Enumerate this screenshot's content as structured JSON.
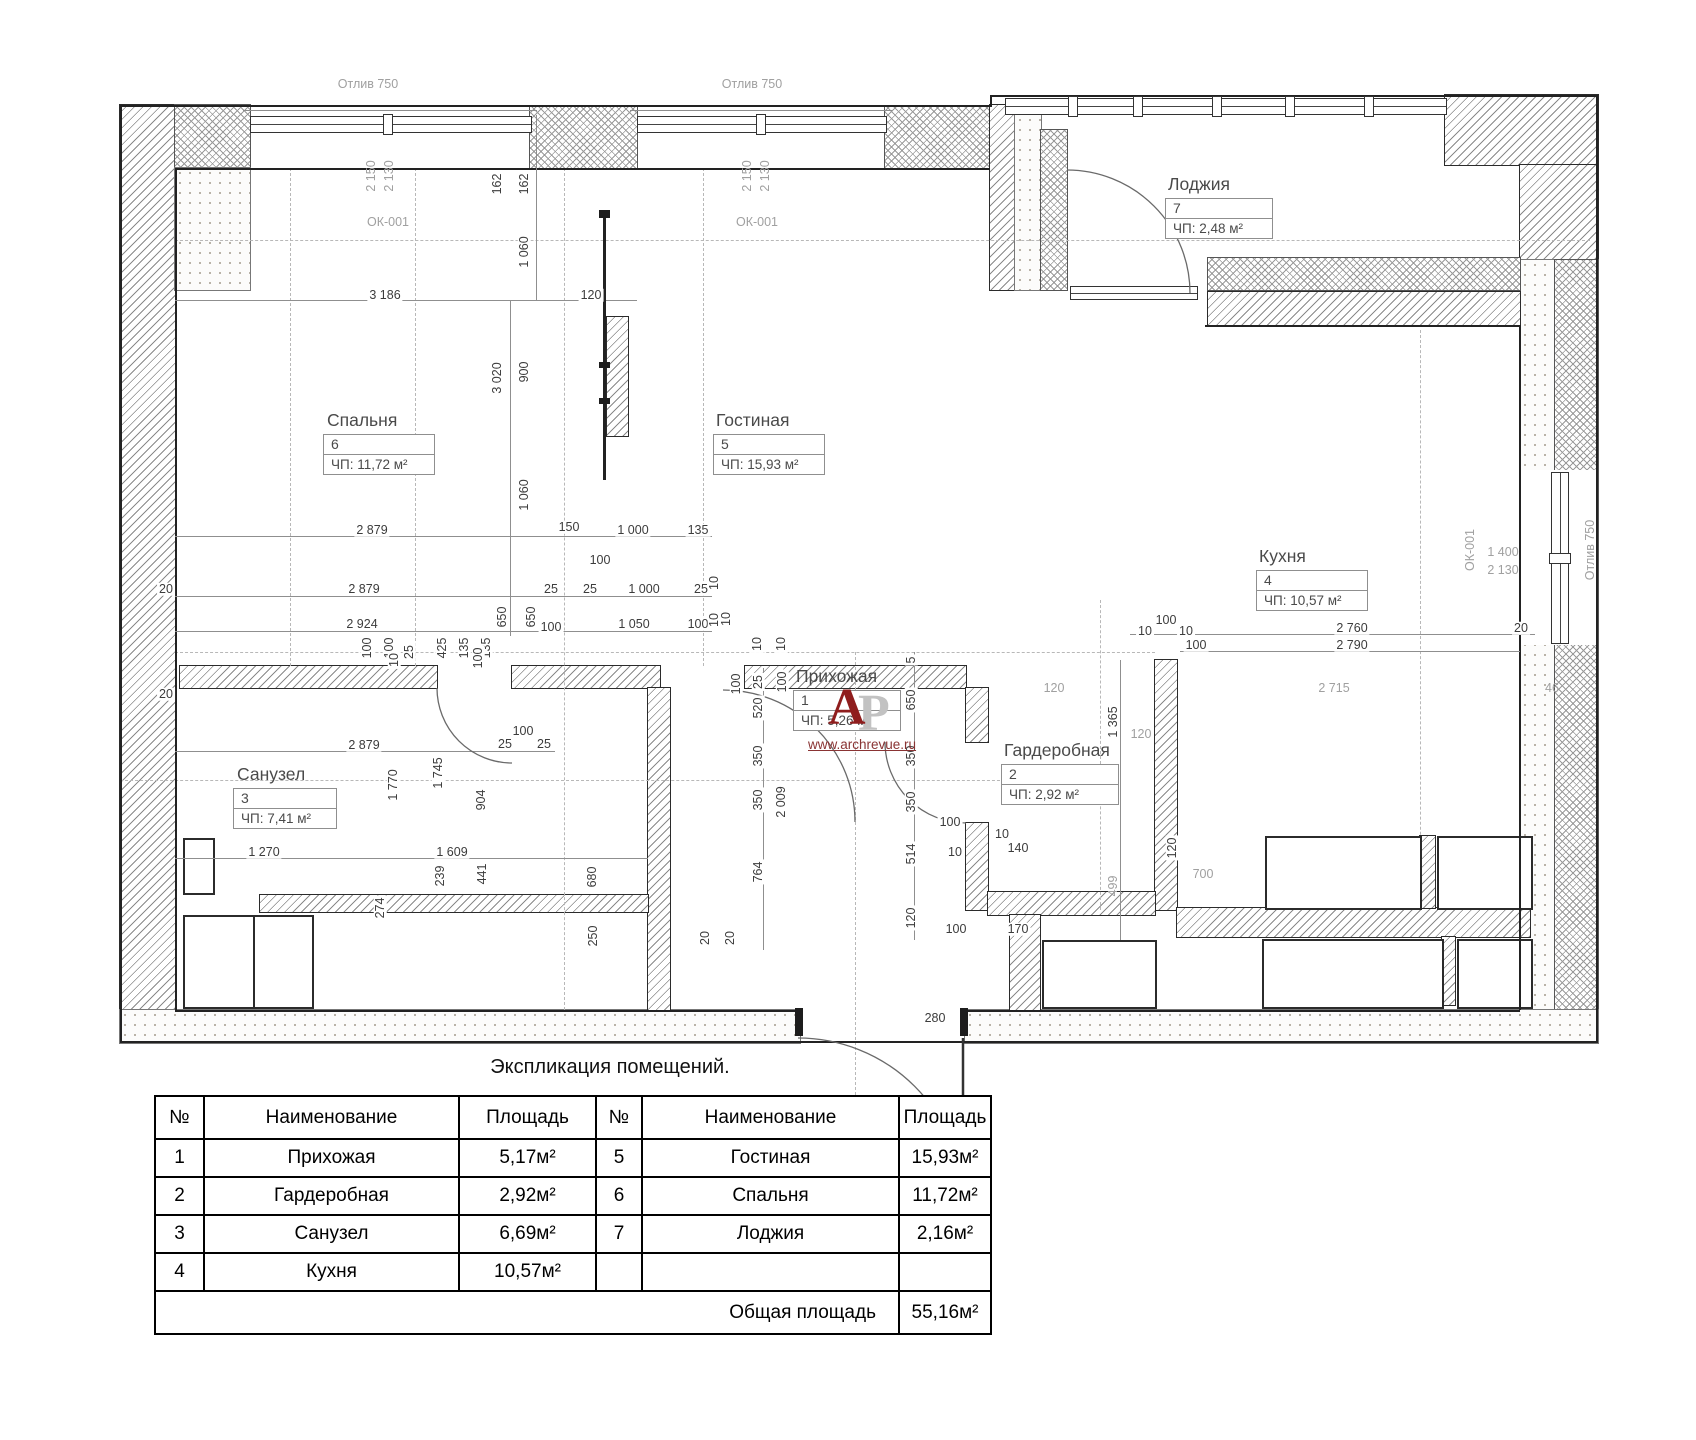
{
  "plan": {
    "rooms": [
      {
        "name": "Спальня",
        "num": "6",
        "area": "ЧП: 11,72 м²",
        "lx": 327,
        "ly": 412,
        "bx": 323,
        "by": 434,
        "bw": 110
      },
      {
        "name": "Гостиная",
        "num": "5",
        "area": "ЧП: 15,93 м²",
        "lx": 716,
        "ly": 412,
        "bx": 713,
        "by": 434,
        "bw": 110
      },
      {
        "name": "Лоджия",
        "num": "7",
        "area": "ЧП: 2,48 м²",
        "lx": 1168,
        "ly": 176,
        "bx": 1165,
        "by": 198,
        "bw": 106
      },
      {
        "name": "Кухня",
        "num": "4",
        "area": "ЧП: 10,57 м²",
        "lx": 1259,
        "ly": 548,
        "bx": 1256,
        "by": 570,
        "bw": 110
      },
      {
        "name": "Прихожая",
        "num": "1",
        "area": "ЧП: 5,26 м²",
        "lx": 796,
        "ly": 668,
        "bx": 793,
        "by": 690,
        "bw": 106
      },
      {
        "name": "Гардеробная",
        "num": "2",
        "area": "ЧП: 2,92 м²",
        "lx": 1004,
        "ly": 742,
        "bx": 1001,
        "by": 764,
        "bw": 116
      },
      {
        "name": "Санузел",
        "num": "3",
        "area": "ЧП: 7,41 м²",
        "lx": 237,
        "ly": 766,
        "bx": 233,
        "by": 788,
        "bw": 102
      }
    ],
    "dims": [
      {
        "t": "Отлив 750",
        "x": 368,
        "y": 84,
        "g": 1
      },
      {
        "t": "Отлив 750",
        "x": 752,
        "y": 84,
        "g": 1
      },
      {
        "t": "2 150",
        "x": 371,
        "y": 176,
        "r": 1,
        "g": 1
      },
      {
        "t": "2 130",
        "x": 389,
        "y": 176,
        "r": 1,
        "g": 1
      },
      {
        "t": "ОК-001",
        "x": 388,
        "y": 222,
        "g": 1
      },
      {
        "t": "2 150",
        "x": 747,
        "y": 176,
        "r": 1,
        "g": 1
      },
      {
        "t": "2 130",
        "x": 765,
        "y": 176,
        "r": 1,
        "g": 1
      },
      {
        "t": "ОК-001",
        "x": 757,
        "y": 222,
        "g": 1
      },
      {
        "t": "162",
        "x": 497,
        "y": 184,
        "r": 1
      },
      {
        "t": "162",
        "x": 524,
        "y": 184,
        "r": 1
      },
      {
        "t": "1 060",
        "x": 524,
        "y": 252,
        "r": 1
      },
      {
        "t": "3 186",
        "x": 385,
        "y": 295
      },
      {
        "t": "120",
        "x": 591,
        "y": 295
      },
      {
        "t": "3 020",
        "x": 497,
        "y": 378,
        "r": 1
      },
      {
        "t": "900",
        "x": 524,
        "y": 372,
        "r": 1
      },
      {
        "t": "1 060",
        "x": 524,
        "y": 495,
        "r": 1
      },
      {
        "t": "2 879",
        "x": 372,
        "y": 530
      },
      {
        "t": "150",
        "x": 569,
        "y": 527
      },
      {
        "t": "1 000",
        "x": 633,
        "y": 530
      },
      {
        "t": "135",
        "x": 698,
        "y": 530
      },
      {
        "t": "100",
        "x": 600,
        "y": 560
      },
      {
        "t": "2 879",
        "x": 364,
        "y": 589
      },
      {
        "t": "25",
        "x": 551,
        "y": 589
      },
      {
        "t": "25",
        "x": 590,
        "y": 589
      },
      {
        "t": "1 000",
        "x": 644,
        "y": 589
      },
      {
        "t": "25",
        "x": 701,
        "y": 589
      },
      {
        "t": "10",
        "x": 714,
        "y": 583,
        "r": 1
      },
      {
        "t": "20",
        "x": 166,
        "y": 589
      },
      {
        "t": "2 924",
        "x": 362,
        "y": 624
      },
      {
        "t": "650",
        "x": 502,
        "y": 617,
        "r": 1
      },
      {
        "t": "650",
        "x": 531,
        "y": 617,
        "r": 1
      },
      {
        "t": "100",
        "x": 551,
        "y": 627
      },
      {
        "t": "1 050",
        "x": 634,
        "y": 624
      },
      {
        "t": "100",
        "x": 698,
        "y": 624
      },
      {
        "t": "10",
        "x": 714,
        "y": 620,
        "r": 1
      },
      {
        "t": "100",
        "x": 367,
        "y": 648,
        "r": 1
      },
      {
        "t": "100",
        "x": 389,
        "y": 648,
        "r": 1
      },
      {
        "t": "25",
        "x": 409,
        "y": 652,
        "r": 1
      },
      {
        "t": "425",
        "x": 442,
        "y": 648,
        "r": 1
      },
      {
        "t": "135",
        "x": 464,
        "y": 648,
        "r": 1
      },
      {
        "t": "135",
        "x": 486,
        "y": 648,
        "r": 1
      },
      {
        "t": "10",
        "x": 394,
        "y": 660,
        "r": 1
      },
      {
        "t": "100",
        "x": 478,
        "y": 658,
        "r": 1
      },
      {
        "t": "20",
        "x": 166,
        "y": 694
      },
      {
        "t": "2 879",
        "x": 364,
        "y": 745
      },
      {
        "t": "100",
        "x": 523,
        "y": 731
      },
      {
        "t": "25",
        "x": 505,
        "y": 744
      },
      {
        "t": "25",
        "x": 544,
        "y": 744
      },
      {
        "t": "1 770",
        "x": 393,
        "y": 785,
        "r": 1
      },
      {
        "t": "1 745",
        "x": 438,
        "y": 773,
        "r": 1
      },
      {
        "t": "904",
        "x": 481,
        "y": 800,
        "r": 1
      },
      {
        "t": "1 270",
        "x": 264,
        "y": 852
      },
      {
        "t": "1 609",
        "x": 452,
        "y": 852
      },
      {
        "t": "274",
        "x": 380,
        "y": 908,
        "r": 1
      },
      {
        "t": "239",
        "x": 440,
        "y": 876,
        "r": 1
      },
      {
        "t": "441",
        "x": 482,
        "y": 874,
        "r": 1
      },
      {
        "t": "680",
        "x": 592,
        "y": 877,
        "r": 1
      },
      {
        "t": "250",
        "x": 593,
        "y": 936,
        "r": 1
      },
      {
        "t": "20",
        "x": 705,
        "y": 938,
        "r": 1
      },
      {
        "t": "20",
        "x": 730,
        "y": 938,
        "r": 1
      },
      {
        "t": "10",
        "x": 726,
        "y": 619,
        "r": 1
      },
      {
        "t": "10",
        "x": 757,
        "y": 644,
        "r": 1
      },
      {
        "t": "10",
        "x": 781,
        "y": 644,
        "r": 1
      },
      {
        "t": "100",
        "x": 736,
        "y": 684,
        "r": 1
      },
      {
        "t": "25",
        "x": 758,
        "y": 682,
        "r": 1
      },
      {
        "t": "100",
        "x": 782,
        "y": 682,
        "r": 1
      },
      {
        "t": "520",
        "x": 758,
        "y": 708,
        "r": 1
      },
      {
        "t": "350",
        "x": 758,
        "y": 756,
        "r": 1
      },
      {
        "t": "350",
        "x": 758,
        "y": 800,
        "r": 1
      },
      {
        "t": "2 009",
        "x": 781,
        "y": 802,
        "r": 1
      },
      {
        "t": "764",
        "x": 758,
        "y": 872,
        "r": 1
      },
      {
        "t": "5",
        "x": 911,
        "y": 660,
        "r": 1
      },
      {
        "t": "650",
        "x": 911,
        "y": 700,
        "r": 1
      },
      {
        "t": "350",
        "x": 911,
        "y": 756,
        "r": 1
      },
      {
        "t": "350",
        "x": 911,
        "y": 802,
        "r": 1
      },
      {
        "t": "514",
        "x": 911,
        "y": 854,
        "r": 1
      },
      {
        "t": "120",
        "x": 911,
        "y": 918,
        "r": 1
      },
      {
        "t": "100",
        "x": 950,
        "y": 822
      },
      {
        "t": "10",
        "x": 955,
        "y": 852
      },
      {
        "t": "10",
        "x": 1002,
        "y": 834
      },
      {
        "t": "140",
        "x": 1018,
        "y": 848
      },
      {
        "t": "100",
        "x": 956,
        "y": 929
      },
      {
        "t": "170",
        "x": 1018,
        "y": 929
      },
      {
        "t": "280",
        "x": 935,
        "y": 1018
      },
      {
        "t": "1 365",
        "x": 1113,
        "y": 722,
        "r": 1
      },
      {
        "t": "120",
        "x": 1141,
        "y": 734,
        "g": 1
      },
      {
        "t": "499",
        "x": 1113,
        "y": 886,
        "r": 1,
        "g": 1
      },
      {
        "t": "700",
        "x": 1203,
        "y": 874,
        "g": 1
      },
      {
        "t": "120",
        "x": 1172,
        "y": 848,
        "r": 1
      },
      {
        "t": "100",
        "x": 1166,
        "y": 620
      },
      {
        "t": "10",
        "x": 1145,
        "y": 631
      },
      {
        "t": "10",
        "x": 1186,
        "y": 631
      },
      {
        "t": "2 760",
        "x": 1352,
        "y": 628
      },
      {
        "t": "20",
        "x": 1521,
        "y": 628
      },
      {
        "t": "100",
        "x": 1196,
        "y": 645
      },
      {
        "t": "2 790",
        "x": 1352,
        "y": 645
      },
      {
        "t": "120",
        "x": 1054,
        "y": 688,
        "g": 1
      },
      {
        "t": "2 715",
        "x": 1334,
        "y": 688,
        "g": 1
      },
      {
        "t": "46",
        "x": 1552,
        "y": 688,
        "g": 1
      },
      {
        "t": "ОК-001",
        "x": 1470,
        "y": 550,
        "r": 1,
        "g": 1
      },
      {
        "t": "1 400",
        "x": 1503,
        "y": 552,
        "g": 1
      },
      {
        "t": "2 130",
        "x": 1503,
        "y": 570,
        "g": 1
      },
      {
        "t": "Отлив 750",
        "x": 1590,
        "y": 550,
        "r": 1,
        "g": 1
      }
    ]
  },
  "watermark": {
    "letter_a": "А",
    "letter_p": "Р",
    "url": "www.archrevue.ru"
  },
  "table": {
    "title": "Экспликация помещений.",
    "headers": [
      "№",
      "Наименование",
      "Площадь",
      "№",
      "Наименование",
      "Площадь"
    ],
    "rows": [
      [
        "1",
        "Прихожая",
        "5,17м²",
        "5",
        "Гостиная",
        "15,93м²"
      ],
      [
        "2",
        "Гардеробная",
        "2,92м²",
        "6",
        "Спальня",
        "11,72м²"
      ],
      [
        "3",
        "Санузел",
        "6,69м²",
        "7",
        "Лоджия",
        "2,16м²"
      ],
      [
        "4",
        "Кухня",
        "10,57м²",
        "",
        "",
        ""
      ]
    ],
    "total_label": "Общая площадь",
    "total_value": "55,16м²"
  }
}
